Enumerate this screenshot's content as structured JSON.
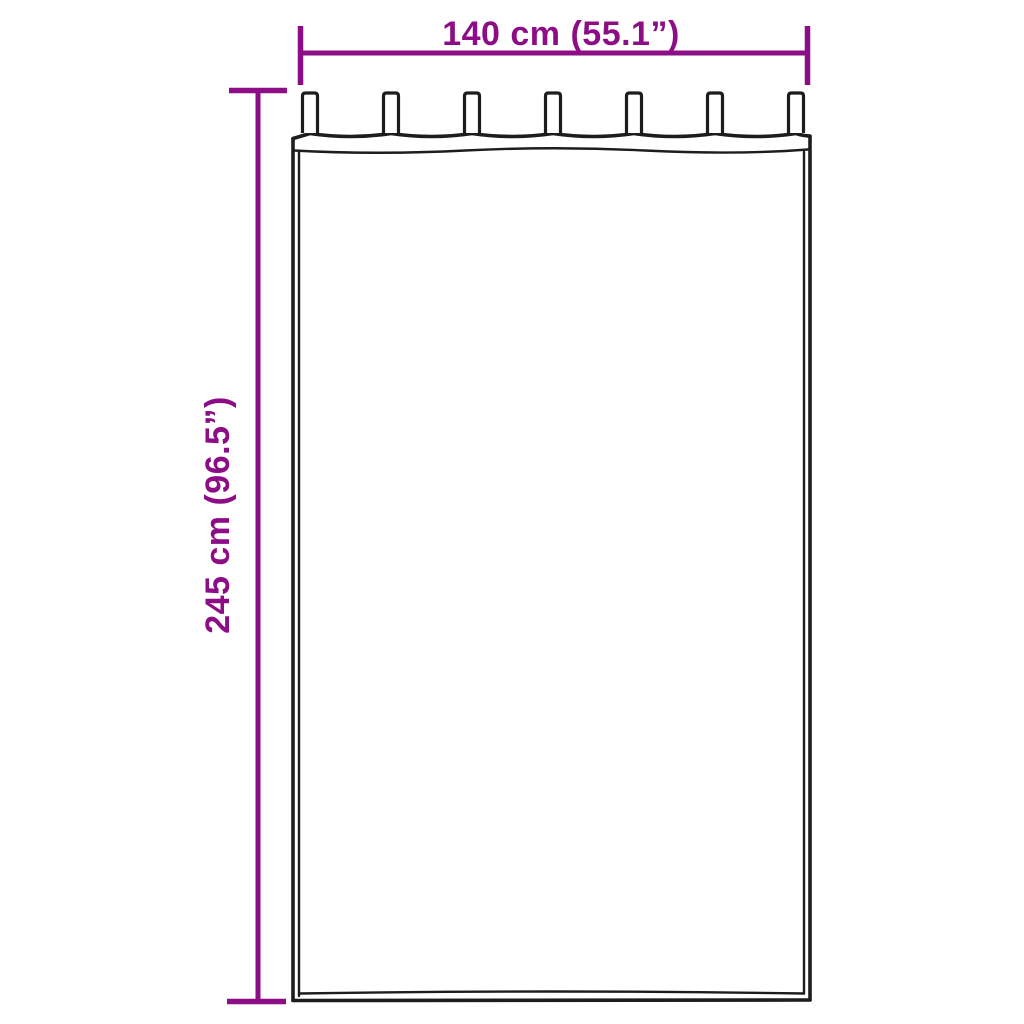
{
  "diagram": {
    "name": "curtain-size-diagram",
    "illustration": "tab-top-curtain-outline",
    "width_dimension": {
      "label": "140 cm (55.1”)"
    },
    "height_dimension": {
      "label": "245 cm (96.5”)"
    },
    "curtain": {
      "tab_count": 7
    },
    "colors": {
      "dimension_accent": "#8c0d86",
      "outline_ink": "#1d1d1b",
      "background": "#ffffff"
    }
  }
}
